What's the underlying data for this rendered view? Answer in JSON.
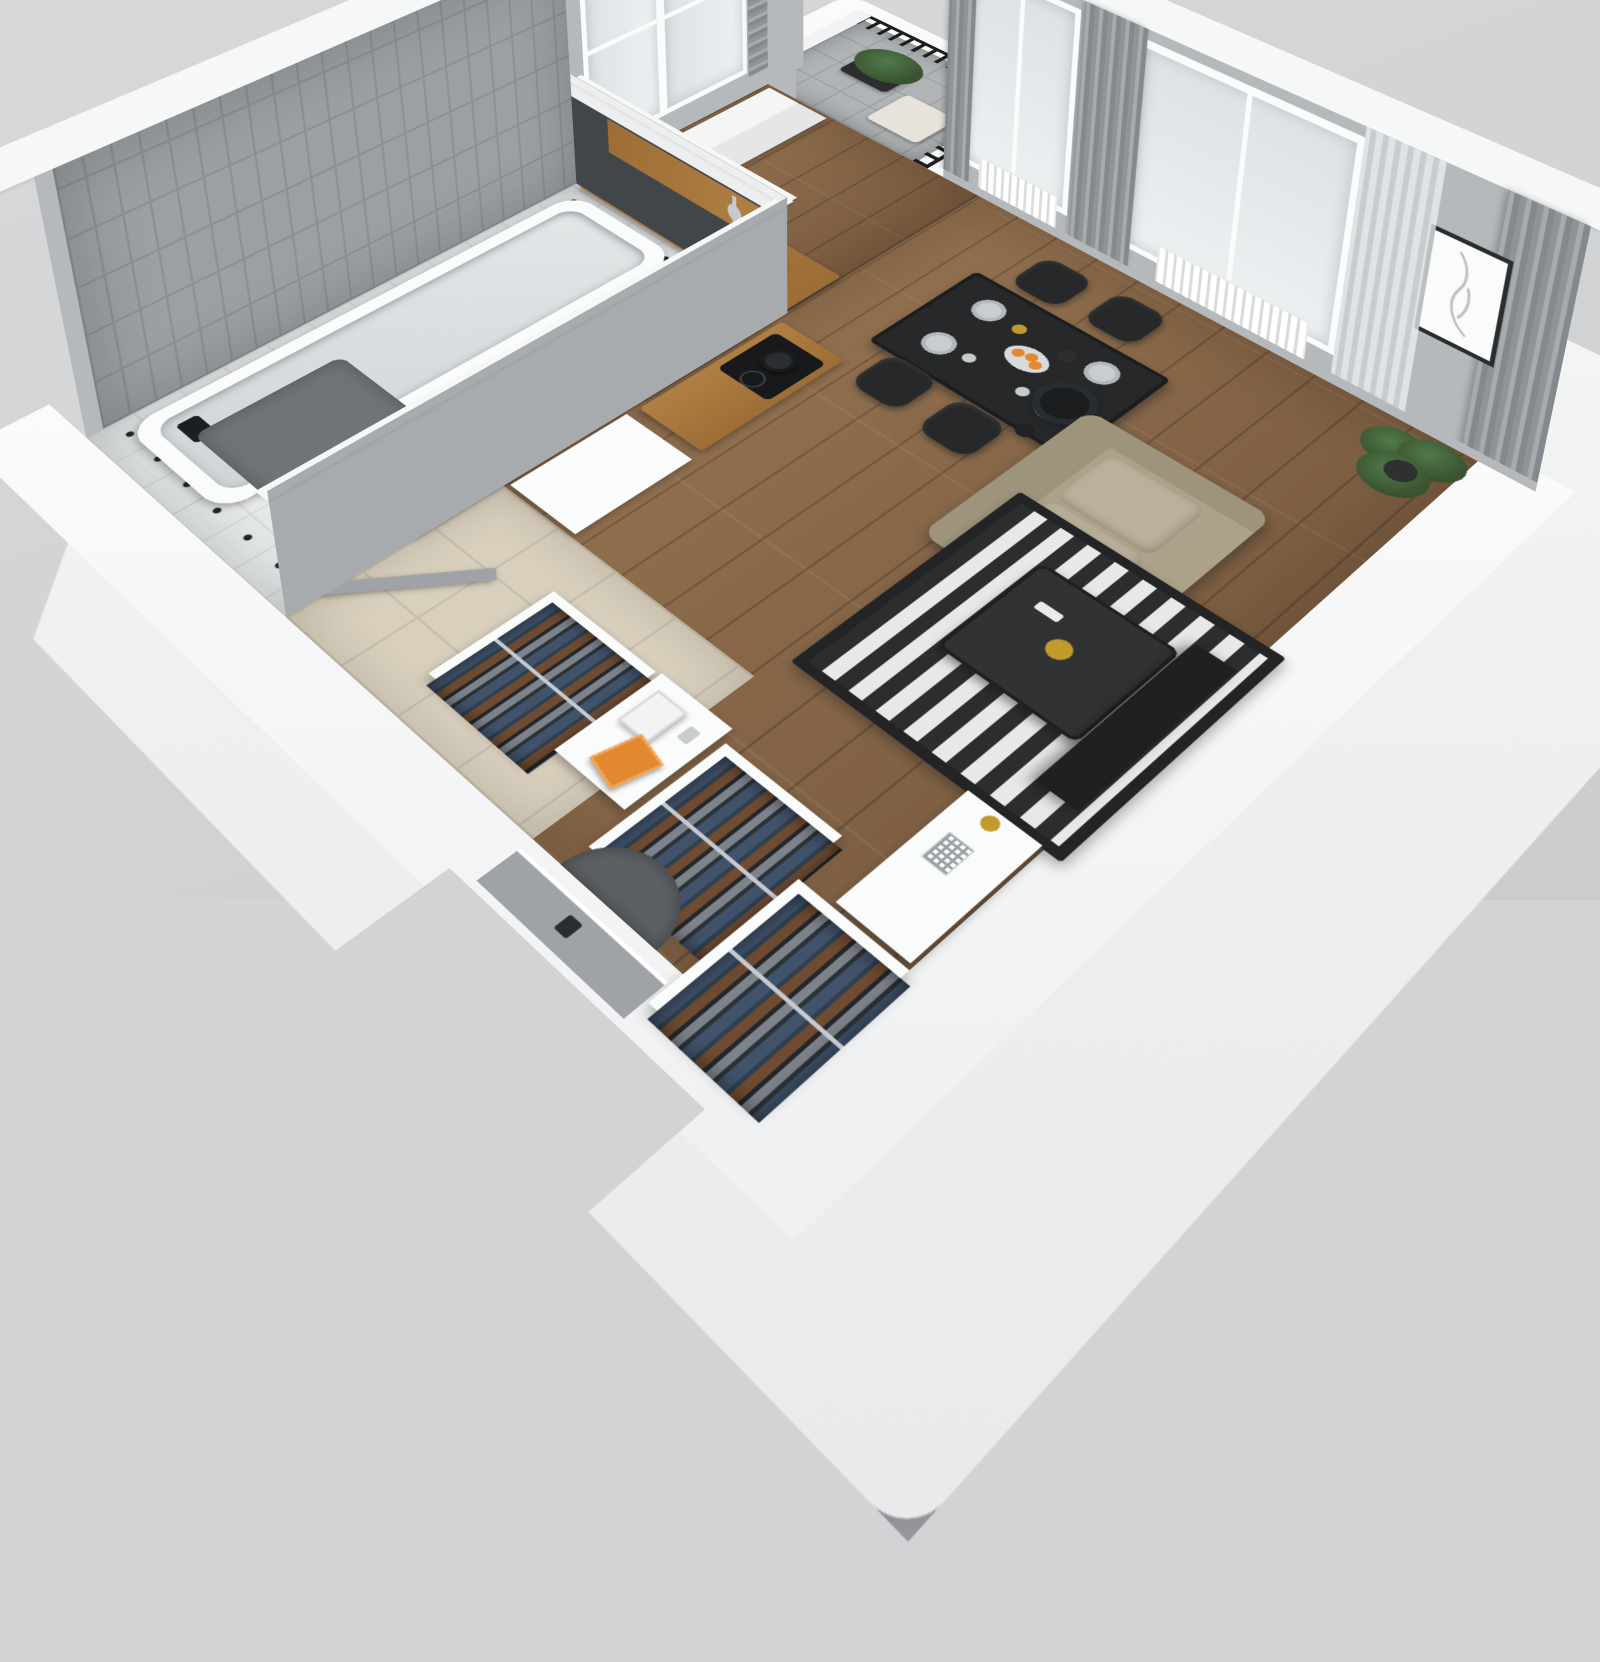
{
  "scene": {
    "description": "3D isometric cutaway render of a studio apartment floor plan on a gray backdrop",
    "view": "axonometric from above, entry corner cut open at bottom",
    "background": "#d2d3d5"
  },
  "palette": {
    "bg": "#d2d3d5",
    "bg2": "#d7d8da",
    "bg3": "#cbccce",
    "wall_top": "#f6f7f7",
    "wall_face": "#b6b9bc",
    "wall_mid": "#a7abae",
    "wall_dark": "#41464b",
    "tile_wall": "#9aa0a3",
    "tile_line": "#8a9093",
    "bath_floor": "#e9ebeb",
    "bath_line": "#d6d9d9",
    "bath_dot": "#212428",
    "wood": "#8a6a4b",
    "wood_l": "#93714f",
    "wood_d": "#7b5d41",
    "oak": "#b07f43",
    "oak_d": "#9c6e36",
    "beige": "#d8cfbd",
    "beige_line": "#c7beac",
    "balcony_floor": "#b0b4b6",
    "balcony_line": "#9da1a3",
    "sofa": "#aca289",
    "sofa_l": "#bab09b",
    "sofa_d": "#9e947c",
    "rug_dark": "#2c2d2f",
    "rug_light": "#e7e8e9",
    "furn_dark": "#2e3032",
    "chair": "#26282a",
    "white": "#fafbfb",
    "chrome": "#c4cad0",
    "glass": "#eef1f2",
    "glass2": "#dde2e5",
    "curtain": "#84898d",
    "curtain2": "#a6abaf",
    "green": "#39522f",
    "green2": "#517a4a",
    "orange": "#e2892f",
    "gold": "#c19a2e",
    "denim": "#41536b",
    "brown": "#6e4b31",
    "clothes_bg": "#555a61",
    "railing": "#1b1d1f",
    "door_gray": "#9fa3a7",
    "washer_door": "#24272a",
    "mat": "#6f7477"
  },
  "rooms": [
    {
      "name": "bathroom",
      "features": [
        "gray-subway-tiled-wall",
        "bathtub",
        "wall-shower-mixer",
        "vanity-with-sink",
        "toilet",
        "washing-machine",
        "dark-bath-mat",
        "white-tile-floor-with-black-dots",
        "open-door"
      ]
    },
    {
      "name": "kitchen",
      "features": [
        "tall-white-cabinet-column",
        "oak-countertop",
        "inset-sink",
        "faucet",
        "black-kettle",
        "coffee-machine",
        "dark-backsplash-wall-with-oak-shelf-band",
        "cooktop-with-pot",
        "white-cabinet-block",
        "two-windows"
      ]
    },
    {
      "name": "living-dining-room",
      "features": [
        "black-dining-table",
        "four-black-chairs",
        "set-tableware-with-orange-fruit-bowl",
        "beige-sofa",
        "black-drum-floor-lamp",
        "black-white-striped-rug",
        "dark-coffee-table-with-gold-vase",
        "tv-panel",
        "white-sideboard-with-label-and-gold-candle",
        "potted-palm",
        "framed-line-art",
        "gray-curtains-and-sheers",
        "two-windows-with-radiators",
        "wood-plank-floor"
      ]
    },
    {
      "name": "hallway-entry",
      "features": [
        "beige-tile-floor",
        "entry-door-with-small-label",
        "half-round-doormat",
        "three-open-wardrobe-sections-with-hanging-clothes",
        "console-with-books-orange-magazine-and-bottle"
      ]
    },
    {
      "name": "balcony",
      "features": [
        "black-vertical-bar-railing",
        "dark-planter-with-plant",
        "light-bench",
        "gray-tile-floor",
        "door-opening-from-living-room"
      ]
    }
  ]
}
